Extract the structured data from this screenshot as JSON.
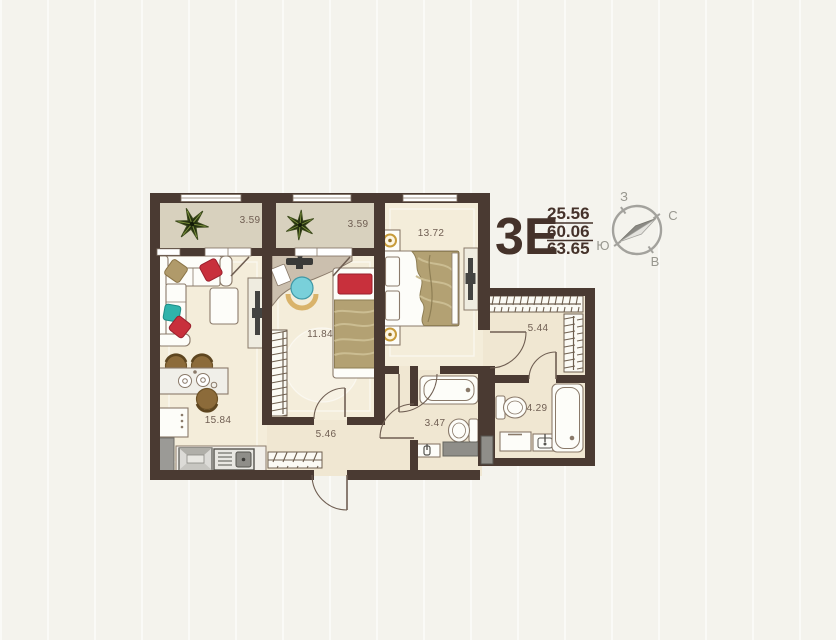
{
  "plan": {
    "title": "3Е",
    "living_area": "25.56",
    "total_area": "60.06",
    "full_area": "63.65"
  },
  "rooms": {
    "balcony_left": "3.59",
    "balcony_right": "3.59",
    "bedroom": "13.72",
    "room_middle": "11.84",
    "kitchen_living": "15.84",
    "hallway": "5.46",
    "hall_closet": "5.44",
    "bathroom_small": "3.47",
    "bathroom_big": "4.29"
  },
  "compass": {
    "north": "С",
    "south": "Ю",
    "west": "З",
    "east": "В"
  },
  "icons": [
    "plant-icon",
    "compass-rose-icon",
    "door-arc",
    "window",
    "wardrobe-hatch"
  ],
  "colors": {
    "wall": "#4a3a32",
    "floor": "#f4edda",
    "floor_wet": "#f0e7d2",
    "balcony_floor": "#d8d1be",
    "accent_red": "#c8303c",
    "accent_teal": "#2fb3ab",
    "chair_teal": "#79d0da",
    "blanket_tan": "#b3a173",
    "title_brown": "#45322a"
  }
}
